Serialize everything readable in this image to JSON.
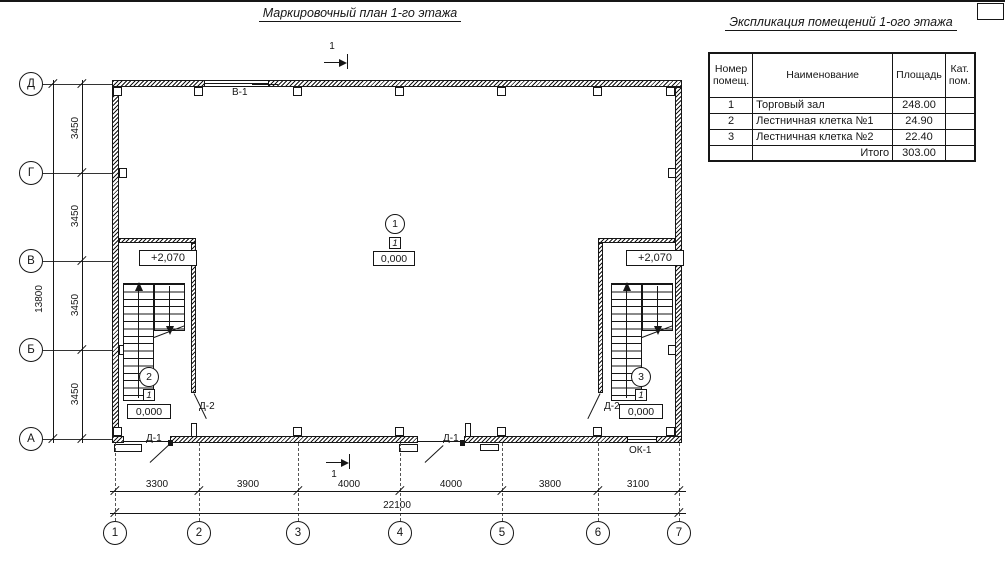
{
  "titles": {
    "plan": "Маркировочный план 1-го этажа",
    "explication": "Экспликация помещений 1-ого этажа"
  },
  "explication_table": {
    "col_headers": [
      "Номер помещ.",
      "Наименование",
      "Площадь",
      "Кат. пом."
    ],
    "rows": [
      {
        "num": "1",
        "name": "Торговый зал",
        "area": "248.00",
        "cat": ""
      },
      {
        "num": "2",
        "name": "Лестничная клетка №1",
        "area": "24.90",
        "cat": ""
      },
      {
        "num": "3",
        "name": "Лестничная клетка №2",
        "area": "22.40",
        "cat": ""
      }
    ],
    "total_label": "Итого",
    "total_area": "303.00"
  },
  "axes": {
    "rows": [
      "Д",
      "Г",
      "В",
      "Б",
      "А"
    ],
    "cols": [
      "1",
      "2",
      "3",
      "4",
      "5",
      "6",
      "7"
    ]
  },
  "dims": {
    "row_segments": [
      "3450",
      "3450",
      "3450",
      "3450"
    ],
    "row_total": "13800",
    "col_segments": [
      "3300",
      "3900",
      "4000",
      "4000",
      "3800",
      "3100"
    ],
    "col_total": "22100"
  },
  "marks": {
    "section": "1",
    "window_top": "В-1",
    "door_1": "Д-1",
    "door_2": "Д-2",
    "window_1": "ОК-1",
    "level_zero": "0,000",
    "level_stair": "+2,070",
    "type_mark": "1"
  },
  "rooms": [
    {
      "number": "1"
    },
    {
      "number": "2"
    },
    {
      "number": "3"
    }
  ]
}
